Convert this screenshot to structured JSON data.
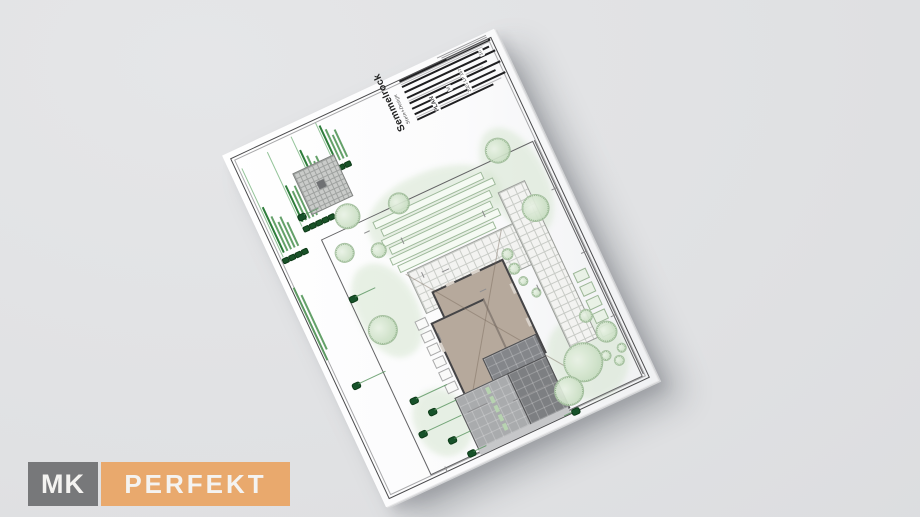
{
  "scene": {
    "background_color": "#e1e2e3"
  },
  "watermark_logo": {
    "mk_text": "MK",
    "perfekt_text": "PERFEKT",
    "mk_bg": "#77787a",
    "perfekt_bg": "#e9a96d",
    "text_color": "#f4f3f1"
  },
  "plan_sheet": {
    "brand": {
      "name": "Semmelrock",
      "tagline": "Stein+Design"
    },
    "title_block": {
      "plan_label": "PLAN",
      "plan_number": "2021 LP 167",
      "scale_label": "M",
      "sheet_number": "10"
    },
    "legend": {
      "columns": 4,
      "marker_color": "#1a5329",
      "text_color": "#49914f"
    },
    "drawing": {
      "building_color": "#b6a99c",
      "paving_dark": "#7d7f82",
      "paving_light": "#a9abad",
      "tile_color": "#f3f3f1",
      "tree_color": "#cfe2c9",
      "boundary_color": "#636365"
    }
  }
}
